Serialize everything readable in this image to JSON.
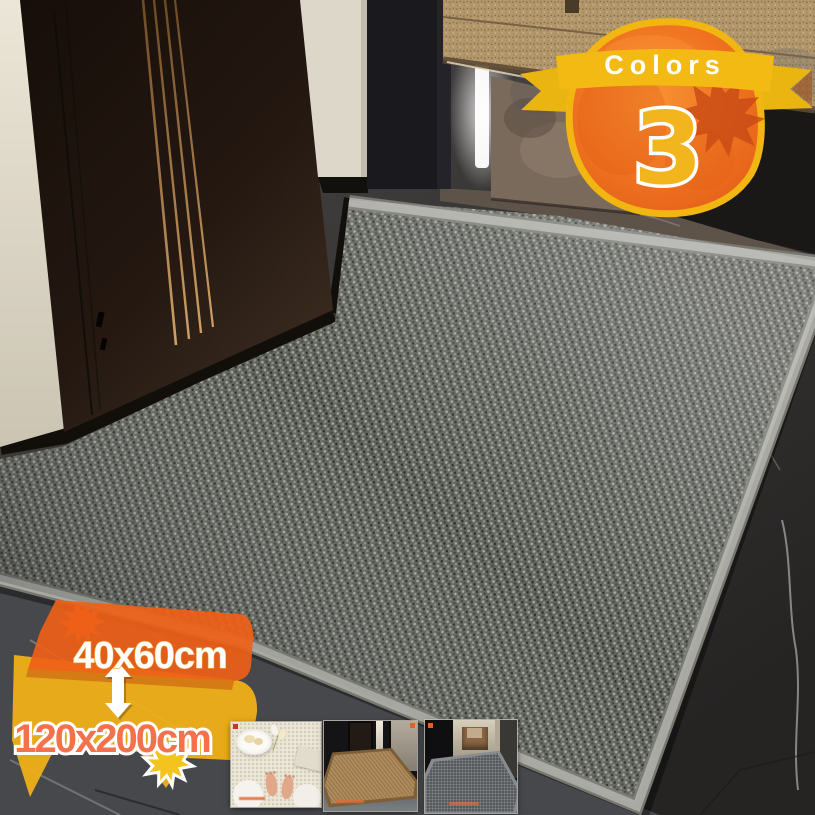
{
  "product_overlays": {
    "colors_badge": {
      "ribbon_label": "Colors",
      "count": "3"
    },
    "size_callout": {
      "size_top": "40x60cm",
      "size_bottom": "120x200cm"
    }
  },
  "palette": {
    "accent_orange": "#ee7220",
    "accent_yellow": "#f3ba16",
    "size_top_text": "#ffffff",
    "size_bottom_text": "#f3714b",
    "mat_gray": "#60625c",
    "binding_gray": "#a9a9a4",
    "cabinet_tan": "#b2976c"
  },
  "icons": {
    "maple_leaf": "maple-leaf-icon",
    "size_range_arrow": "double-headed-vertical-arrow-icon"
  },
  "variants": {
    "items": [
      {
        "key": "beige"
      },
      {
        "key": "brown"
      },
      {
        "key": "grey"
      }
    ]
  }
}
